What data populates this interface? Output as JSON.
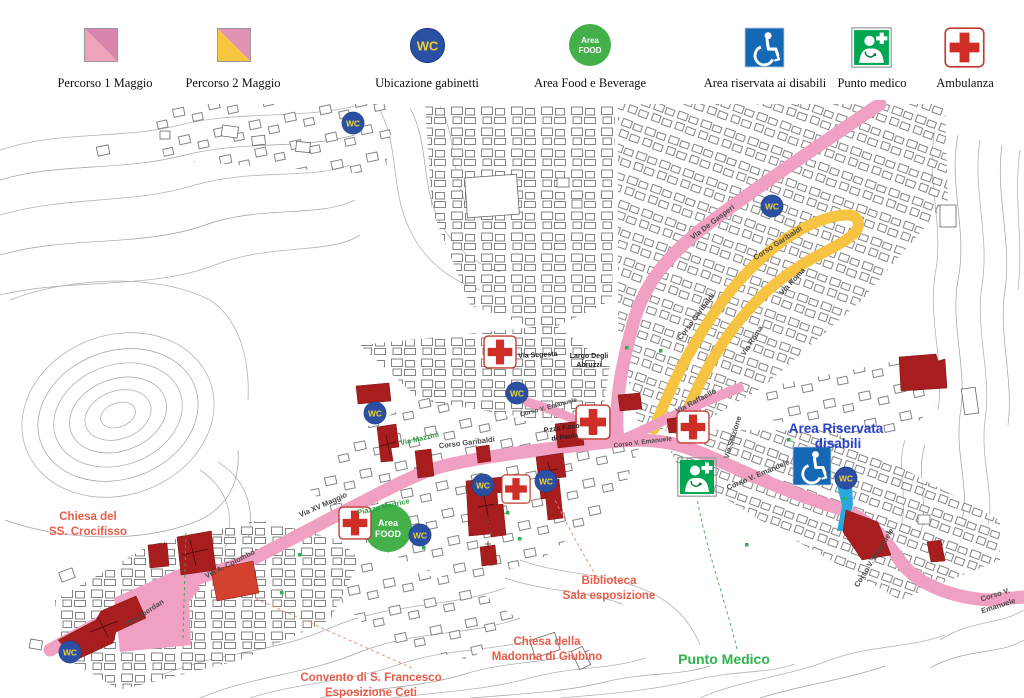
{
  "legend": {
    "percorso1": "Percorso 1 Maggio",
    "percorso2": "Percorso 2 Maggio",
    "wc": "Ubicazione gabinetti",
    "food": "Area Food e Beverage",
    "disabili": "Area riservata ai disabili",
    "medico": "Punto medico",
    "ambulanza": "Ambulanza"
  },
  "icon_text": {
    "wc": "WC",
    "food_line1": "Area",
    "food_line2": "FOOD"
  },
  "colors": {
    "route_pink": "#f0a0c2",
    "route_pink_dark": "#d886ab",
    "route_pink_light": "#efa3ba",
    "route_yellow": "#f7c342",
    "wc_blue": "#2b50a3",
    "wc_yellow": "#f2d22e",
    "food_green": "#43b04a",
    "medico_green": "#00a651",
    "disabled_blue": "#1568b3",
    "cross_red": "#cf2e26",
    "building_dark_red": "#a81d1d",
    "building_orange_red": "#d2422e",
    "cyan_band": "#29a8e0",
    "poi_red": "#e95c49",
    "poi_green": "#2db34a",
    "poi_blue": "#2742c8"
  },
  "map": {
    "streets": {
      "de_gasperi": "Via De Gasperi",
      "garibaldi_yellow_upper": "Corso Garibaldi",
      "roma_upper": "Via Roma",
      "garibaldi_yellow_lower": "Corso Garibaldi",
      "roma_lower": "Via Roma",
      "segesta": "Via Segesta",
      "largo_abruzzi_1": "Largo Degli",
      "largo_abruzzi_2": "Abruzzi",
      "garibaldi_main": "Corso Garibaldi",
      "mazzini": "Via Mazzini",
      "xv_maggio": "Via XV Maggio",
      "colombo": "Via A. Colombo",
      "oberdan": "Via Oberdan",
      "emanuele_junction": "Corso V. Emanuele",
      "raffaello": "Via Raffaello",
      "stazione": "Via Stazione",
      "emanuele_mid": "Corso V. Emanuele",
      "emanuele_bend": "Corso V. Emanuele",
      "emanuele_right_1": "Corso V.",
      "emanuele_right_2": "Emanuele",
      "emanuele_spur": "Corso V. Emanuele",
      "pzza_paola_1": "P.zza F.sco",
      "pzza_paola_2": "di Paola",
      "madrice": "Piazza Madrice"
    },
    "pois": {
      "crocifisso_1": "Chiesa del",
      "crocifisso_2": "SS. Crocifisso",
      "convento_1": "Convento di S. Francesco",
      "convento_2": "Esposizione Ceti",
      "giubino_1": "Chiesa della",
      "giubino_2": "Madonna di Giubino",
      "biblioteca_1": "Biblioteca",
      "biblioteca_2": "Sala esposizione",
      "punto_medico": "Punto Medico",
      "riservata_1": "Area Riservata",
      "riservata_2": "disabili"
    }
  }
}
